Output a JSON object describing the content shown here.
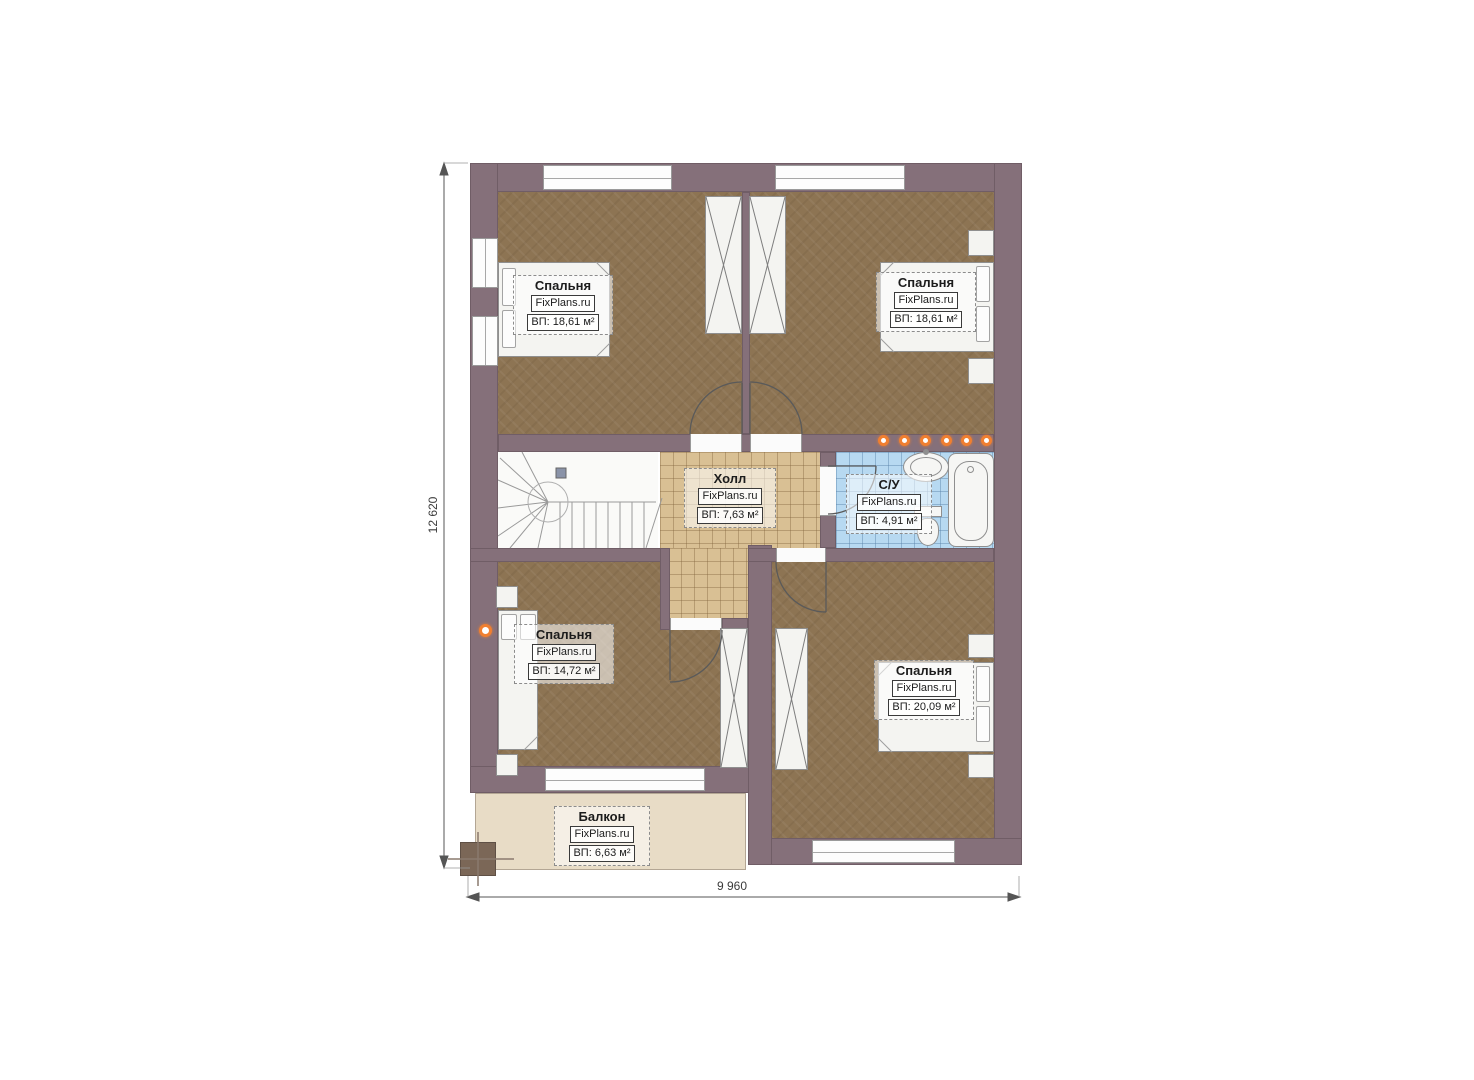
{
  "plan": {
    "title": "Floor plan (second storey)",
    "site": "FixPlans.ru",
    "rooms": [
      {
        "id": "bedroom-top-left",
        "name": "Спальня",
        "brand": "FixPlans.ru",
        "area": "ВП: 18,61 м²"
      },
      {
        "id": "bedroom-top-right",
        "name": "Спальня",
        "brand": "FixPlans.ru",
        "area": "ВП: 18,61 м²"
      },
      {
        "id": "hall",
        "name": "Холл",
        "brand": "FixPlans.ru",
        "area": "ВП: 7,63 м²"
      },
      {
        "id": "bathroom",
        "name": "С/У",
        "brand": "FixPlans.ru",
        "area": "ВП: 4,91 м²"
      },
      {
        "id": "bedroom-bottom-left",
        "name": "Спальня",
        "brand": "FixPlans.ru",
        "area": "ВП: 14,72 м²"
      },
      {
        "id": "bedroom-bottom-right",
        "name": "Спальня",
        "brand": "FixPlans.ru",
        "area": "ВП: 20,09 м²"
      },
      {
        "id": "balcony",
        "name": "Балкон",
        "brand": "FixPlans.ru",
        "area": "ВП: 6,63 м²"
      }
    ],
    "dimensions": {
      "height_mm": "12 620",
      "width_mm": "9 960"
    },
    "colors": {
      "wall": "#85707a",
      "wood_floor": "#8d7453",
      "hall_tile": "#d9c094",
      "bath_tile": "#b7d9f1",
      "balcony_deck": "#e8dcc6",
      "accent_orange": "#f07f30"
    }
  }
}
